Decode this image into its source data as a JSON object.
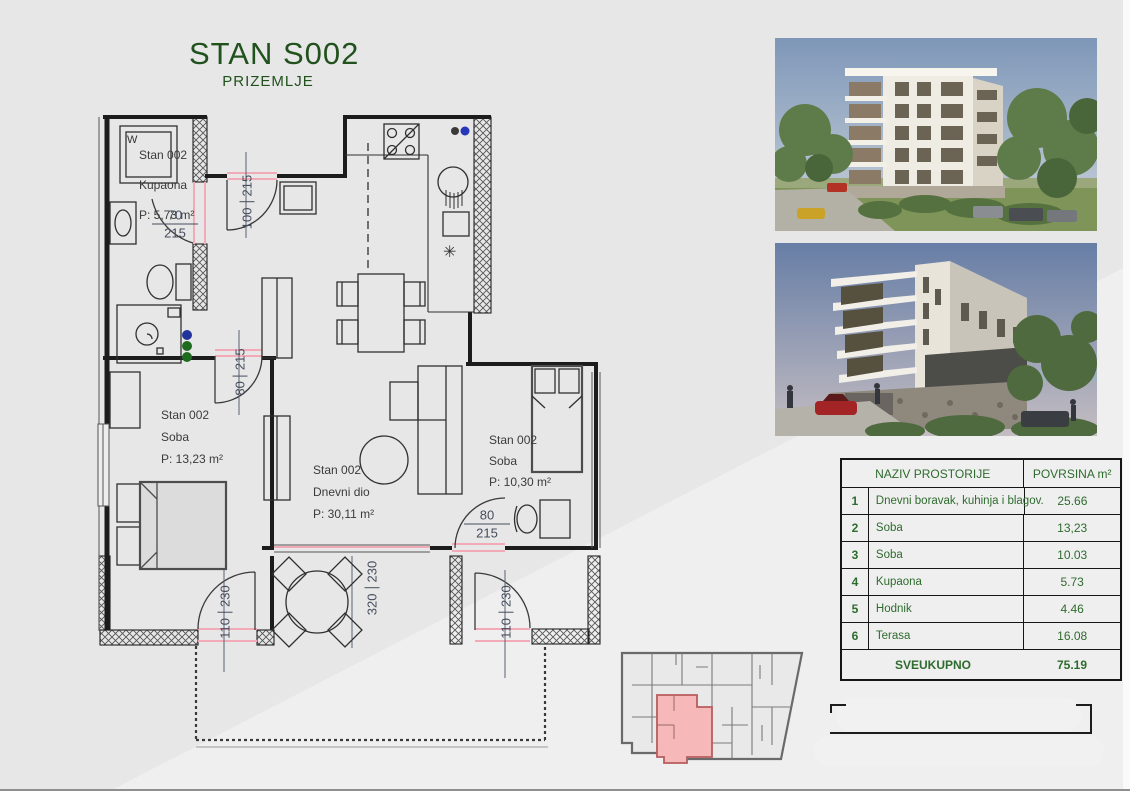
{
  "page": {
    "title": "STAN S002",
    "subtitle": "PRIZEMLJE"
  },
  "floor_plan": {
    "washer_label": "W",
    "fridge_symbol": "✳",
    "rooms": [
      {
        "unit": "Stan 002",
        "name": "Kupaona",
        "area": "P: 5,73 m²"
      },
      {
        "unit": "Stan 002",
        "name": "Soba",
        "area": "P: 13,23 m²"
      },
      {
        "unit": "Stan 002",
        "name": "Dnevni dio",
        "area": "P: 30,11 m²"
      },
      {
        "unit": "Stan 002",
        "name": "Soba",
        "area": "P: 10,30 m²"
      }
    ],
    "dimensions": [
      {
        "width": "70",
        "height": "215"
      },
      {
        "width": "100",
        "height": "215"
      },
      {
        "width": "80",
        "height": "215"
      },
      {
        "width": "80",
        "height": "215"
      },
      {
        "width": "110",
        "height": "230"
      },
      {
        "width": "320",
        "height": "230"
      },
      {
        "width": "110",
        "height": "230"
      }
    ]
  },
  "area_table": {
    "header": {
      "name_col": "NAZIV PROSTORIJE",
      "area_col": "POVRSINA m²"
    },
    "rows": [
      {
        "num": "1",
        "name": "Dnevni boravak, kuhinja i blagov.",
        "area": "25.66"
      },
      {
        "num": "2",
        "name": "Soba",
        "area": "13,23"
      },
      {
        "num": "3",
        "name": "Soba",
        "area": "10.03"
      },
      {
        "num": "4",
        "name": "Kupaona",
        "area": "5.73"
      },
      {
        "num": "5",
        "name": "Hodnik",
        "area": "4.46"
      },
      {
        "num": "6",
        "name": "Terasa",
        "area": "16.08"
      }
    ],
    "footer": {
      "label": "SVEUKUPNO",
      "total": "75.19"
    }
  },
  "colors": {
    "title_green": "#21521d",
    "table_green": "#2e6b2e",
    "door_accent_pink": "#f2a9b8",
    "keyplan_unit_fill": "#f6b8b8",
    "page_background": "#e7e7e7"
  }
}
